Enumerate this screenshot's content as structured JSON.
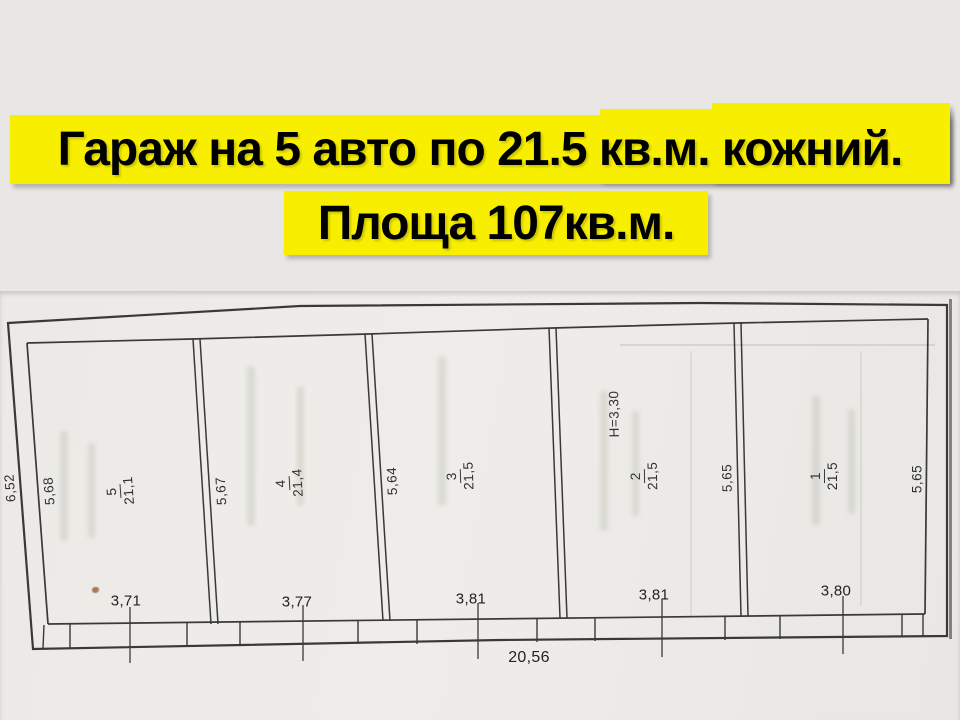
{
  "title": {
    "line1": "Гараж на 5 авто по 21.5 кв.м. кожний.",
    "line2": "Площа 107кв.м."
  },
  "plan": {
    "rooms": [
      {
        "number": "5",
        "area": "21,1"
      },
      {
        "number": "4",
        "area": "21,4"
      },
      {
        "number": "3",
        "area": "21,5"
      },
      {
        "number": "2",
        "area": "21,5"
      },
      {
        "number": "1",
        "area": "21,5"
      }
    ],
    "dims": {
      "outer_left": "6,52",
      "verticals": [
        "5,68",
        "5,67",
        "5,64",
        "5,65",
        "5,65"
      ],
      "height_mark": "H=3,30",
      "bottom_widths": [
        "3,71",
        "3,77",
        "3,81",
        "3,81",
        "3,80"
      ],
      "total_width": "20,56"
    }
  },
  "colors": {
    "highlight": "#f8ef00",
    "background": "#e9e7e5",
    "paper": "#edebe7",
    "line": "#3a3a3c"
  }
}
